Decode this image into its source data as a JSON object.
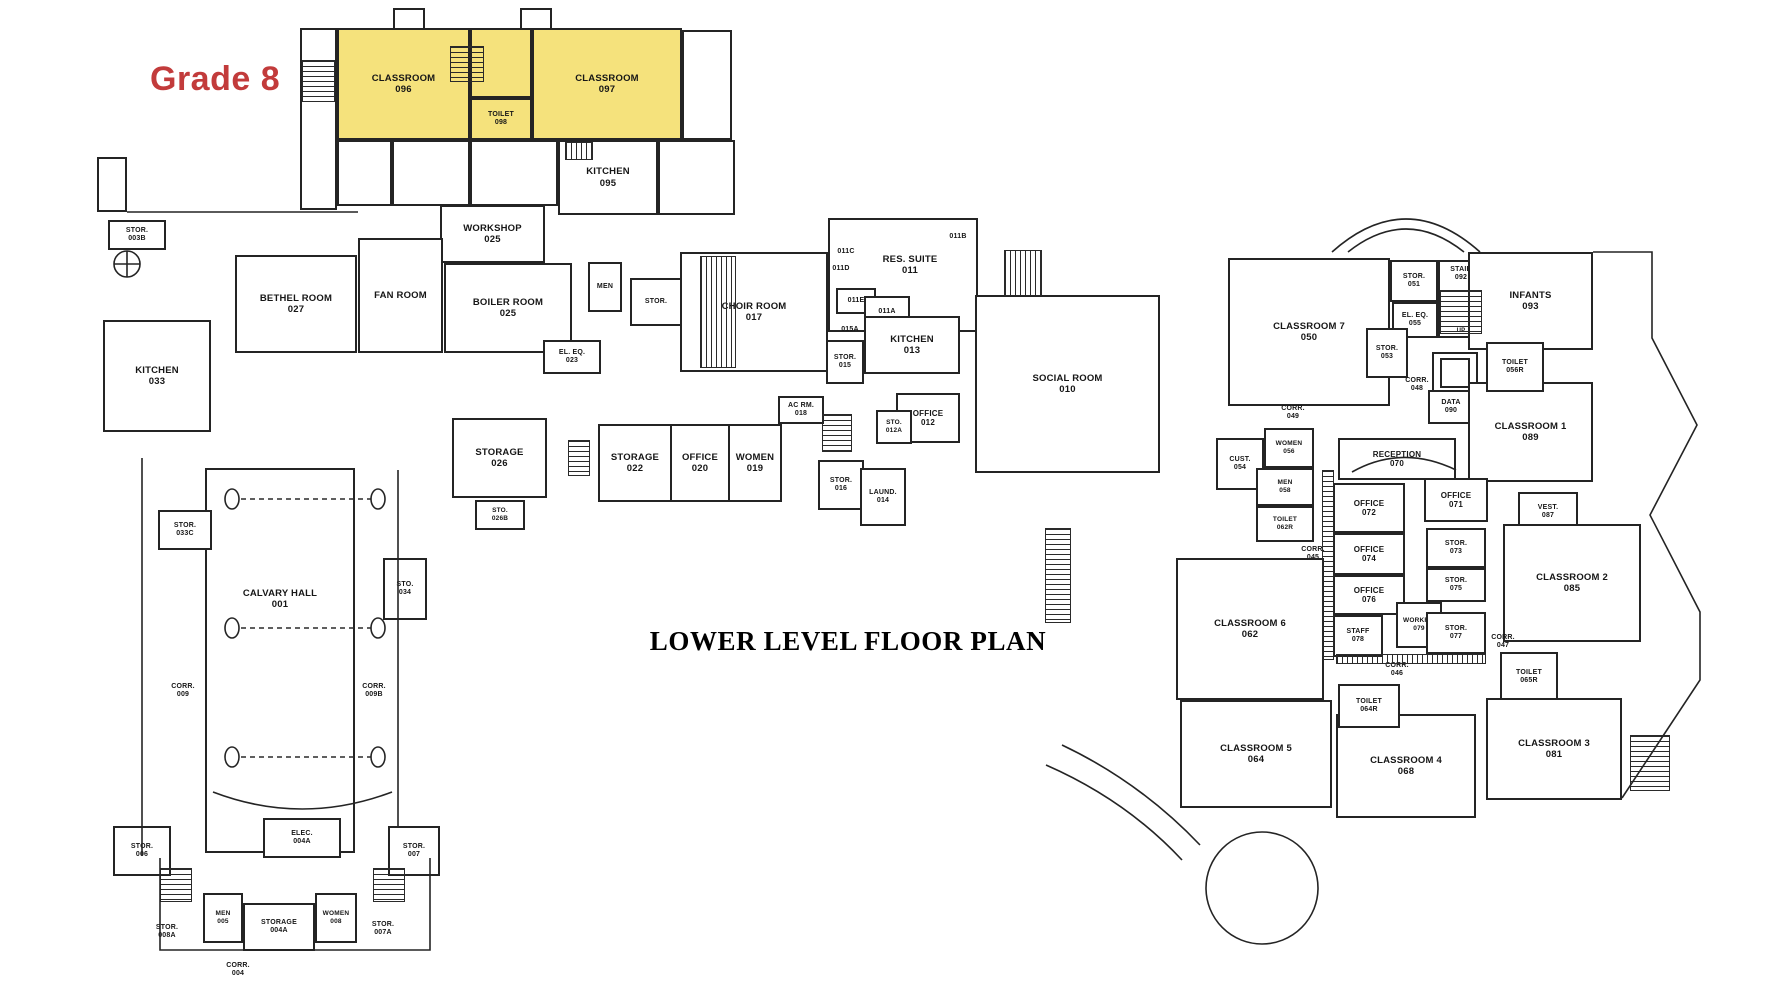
{
  "page": {
    "title": "LOWER LEVEL FLOOR PLAN",
    "annotation": "Grade 8"
  },
  "colors": {
    "highlight": "#F5E27C",
    "annotation": "#C23B3B",
    "wall": "#242424"
  },
  "rooms": [
    {
      "name": "CLASSROOM",
      "number": "096",
      "x": 337,
      "y": 28,
      "w": 133,
      "h": 112,
      "highlight": true
    },
    {
      "name": "",
      "number": "",
      "x": 470,
      "y": 28,
      "w": 62,
      "h": 70,
      "highlight": true
    },
    {
      "name": "TOILET",
      "number": "098",
      "x": 470,
      "y": 98,
      "w": 62,
      "h": 42,
      "highlight": true,
      "fs": 7
    },
    {
      "name": "CLASSROOM",
      "number": "097",
      "x": 532,
      "y": 28,
      "w": 150,
      "h": 112,
      "highlight": true
    },
    {
      "name": "KITCHEN",
      "number": "095",
      "x": 558,
      "y": 140,
      "w": 100,
      "h": 75
    },
    {
      "name": "WORKSHOP",
      "number": "025",
      "x": 440,
      "y": 205,
      "w": 105,
      "h": 58
    },
    {
      "name": "BETHEL ROOM",
      "number": "027",
      "x": 235,
      "y": 255,
      "w": 122,
      "h": 98
    },
    {
      "name": "FAN ROOM",
      "number": "",
      "x": 358,
      "y": 238,
      "w": 85,
      "h": 115
    },
    {
      "name": "BOILER ROOM",
      "number": "025",
      "x": 444,
      "y": 263,
      "w": 128,
      "h": 90
    },
    {
      "name": "MEN",
      "number": "",
      "x": 588,
      "y": 262,
      "w": 34,
      "h": 50,
      "fs": 7
    },
    {
      "name": "STOR.",
      "number": "",
      "x": 630,
      "y": 278,
      "w": 52,
      "h": 48,
      "fs": 7
    },
    {
      "name": "KITCHEN",
      "number": "033",
      "x": 103,
      "y": 320,
      "w": 108,
      "h": 112
    },
    {
      "name": "STOR.",
      "number": "003B",
      "x": 108,
      "y": 220,
      "w": 58,
      "h": 30,
      "fs": 7
    },
    {
      "name": "EL. EQ.",
      "number": "023",
      "x": 543,
      "y": 340,
      "w": 58,
      "h": 34,
      "fs": 7
    },
    {
      "name": "CHOIR ROOM",
      "number": "017",
      "x": 680,
      "y": 252,
      "w": 148,
      "h": 120
    },
    {
      "name": "",
      "number": "",
      "x": 828,
      "y": 218,
      "w": 150,
      "h": 114
    },
    {
      "name": "RES. SUITE",
      "number": "011",
      "x": 858,
      "y": 248,
      "w": 104,
      "h": 34,
      "nobox": true
    },
    {
      "name": "011C",
      "number": "",
      "x": 828,
      "y": 246,
      "w": 36,
      "h": 13,
      "nobox": true,
      "fs": 7
    },
    {
      "name": "011D",
      "number": "",
      "x": 823,
      "y": 263,
      "w": 36,
      "h": 13,
      "nobox": true,
      "fs": 7
    },
    {
      "name": "011B",
      "number": "",
      "x": 940,
      "y": 231,
      "w": 36,
      "h": 13,
      "nobox": true,
      "fs": 7
    },
    {
      "name": "011E",
      "number": "",
      "x": 836,
      "y": 288,
      "w": 40,
      "h": 26,
      "fs": 7
    },
    {
      "name": "011A",
      "number": "",
      "x": 864,
      "y": 296,
      "w": 46,
      "h": 32,
      "fs": 7
    },
    {
      "name": "KITCHEN",
      "number": "013",
      "x": 864,
      "y": 316,
      "w": 96,
      "h": 58
    },
    {
      "name": "015A",
      "number": "",
      "x": 832,
      "y": 324,
      "w": 36,
      "h": 13,
      "nobox": true,
      "fs": 7
    },
    {
      "name": "STOR.",
      "number": "015",
      "x": 826,
      "y": 340,
      "w": 38,
      "h": 44,
      "fs": 7
    },
    {
      "name": "SOCIAL ROOM",
      "number": "010",
      "x": 975,
      "y": 295,
      "w": 185,
      "h": 178
    },
    {
      "name": "OFFICE",
      "number": "012",
      "x": 896,
      "y": 393,
      "w": 64,
      "h": 50,
      "fs": 8
    },
    {
      "name": "STO.",
      "number": "012A",
      "x": 876,
      "y": 410,
      "w": 36,
      "h": 34,
      "fs": 6.5
    },
    {
      "name": "AC RM.",
      "number": "018",
      "x": 778,
      "y": 396,
      "w": 46,
      "h": 28,
      "fs": 7
    },
    {
      "name": "WOMEN",
      "number": "019",
      "x": 728,
      "y": 424,
      "w": 54,
      "h": 78
    },
    {
      "name": "OFFICE",
      "number": "020",
      "x": 670,
      "y": 424,
      "w": 60,
      "h": 78
    },
    {
      "name": "STORAGE",
      "number": "022",
      "x": 598,
      "y": 424,
      "w": 74,
      "h": 78
    },
    {
      "name": "STORAGE",
      "number": "026",
      "x": 452,
      "y": 418,
      "w": 95,
      "h": 80
    },
    {
      "name": "STO.",
      "number": "026B",
      "x": 475,
      "y": 500,
      "w": 50,
      "h": 30,
      "fs": 6.5
    },
    {
      "name": "STOR.",
      "number": "016",
      "x": 818,
      "y": 460,
      "w": 46,
      "h": 50,
      "fs": 7
    },
    {
      "name": "LAUND.",
      "number": "014",
      "x": 860,
      "y": 468,
      "w": 46,
      "h": 58,
      "fs": 7
    },
    {
      "name": "CALVARY HALL",
      "number": "001",
      "x": 205,
      "y": 468,
      "w": 150,
      "h": 385,
      "lt": 118
    },
    {
      "name": "STOR.",
      "number": "033C",
      "x": 158,
      "y": 510,
      "w": 54,
      "h": 40,
      "fs": 7
    },
    {
      "name": "STO.",
      "number": "034",
      "x": 383,
      "y": 558,
      "w": 44,
      "h": 62,
      "fs": 7
    },
    {
      "name": "CORR.",
      "number": "009",
      "x": 160,
      "y": 678,
      "w": 46,
      "h": 26,
      "nobox": true,
      "fs": 7
    },
    {
      "name": "CORR.",
      "number": "009B",
      "x": 350,
      "y": 678,
      "w": 48,
      "h": 26,
      "nobox": true,
      "fs": 7
    },
    {
      "name": "STOR.",
      "number": "006",
      "x": 113,
      "y": 826,
      "w": 58,
      "h": 50,
      "fs": 7
    },
    {
      "name": "ELEC.",
      "number": "004A",
      "x": 263,
      "y": 818,
      "w": 78,
      "h": 40,
      "fs": 7
    },
    {
      "name": "STOR.",
      "number": "007",
      "x": 388,
      "y": 826,
      "w": 52,
      "h": 50,
      "fs": 7
    },
    {
      "name": "STOR.",
      "number": "008A",
      "x": 142,
      "y": 918,
      "w": 50,
      "h": 28,
      "nobox": true,
      "fs": 7
    },
    {
      "name": "MEN",
      "number": "005",
      "x": 203,
      "y": 893,
      "w": 40,
      "h": 50,
      "fs": 6.5
    },
    {
      "name": "STORAGE",
      "number": "004A",
      "x": 243,
      "y": 903,
      "w": 72,
      "h": 48,
      "fs": 7
    },
    {
      "name": "WOMEN",
      "number": "008",
      "x": 315,
      "y": 893,
      "w": 42,
      "h": 50,
      "fs": 6.5
    },
    {
      "name": "STOR.",
      "number": "007A",
      "x": 358,
      "y": 915,
      "w": 50,
      "h": 28,
      "nobox": true,
      "fs": 7
    },
    {
      "name": "CORR.",
      "number": "004",
      "x": 215,
      "y": 956,
      "w": 46,
      "h": 28,
      "nobox": true,
      "fs": 7
    },
    {
      "name": "CLASSROOM 7",
      "number": "050",
      "x": 1228,
      "y": 258,
      "w": 162,
      "h": 148
    },
    {
      "name": "STOR.",
      "number": "051",
      "x": 1390,
      "y": 260,
      "w": 48,
      "h": 42,
      "fs": 7
    },
    {
      "name": "STAIR",
      "number": "092",
      "x": 1438,
      "y": 260,
      "w": 46,
      "h": 78,
      "fs": 7,
      "lt": 4
    },
    {
      "name": "UP",
      "number": "",
      "x": 1448,
      "y": 326,
      "w": 26,
      "h": 12,
      "nobox": true,
      "fs": 6
    },
    {
      "name": "EL. EQ.",
      "number": "055",
      "x": 1392,
      "y": 302,
      "w": 46,
      "h": 36,
      "fs": 7
    },
    {
      "name": "STOR.",
      "number": "053",
      "x": 1366,
      "y": 328,
      "w": 42,
      "h": 50,
      "fs": 7
    },
    {
      "name": "CORR.",
      "number": "048",
      "x": 1394,
      "y": 372,
      "w": 46,
      "h": 26,
      "nobox": true,
      "fs": 7
    },
    {
      "name": "DATA",
      "number": "090",
      "x": 1428,
      "y": 390,
      "w": 46,
      "h": 34,
      "fs": 7
    },
    {
      "name": "INFANTS",
      "number": "093",
      "x": 1468,
      "y": 252,
      "w": 125,
      "h": 98
    },
    {
      "name": "CLASSROOM 1",
      "number": "089",
      "x": 1468,
      "y": 382,
      "w": 125,
      "h": 100
    },
    {
      "name": "TOILET",
      "number": "056R",
      "x": 1486,
      "y": 342,
      "w": 58,
      "h": 50,
      "fs": 7
    },
    {
      "name": "CORR.",
      "number": "049",
      "x": 1270,
      "y": 400,
      "w": 46,
      "h": 26,
      "nobox": true,
      "fs": 7
    },
    {
      "name": "CUST.",
      "number": "054",
      "x": 1216,
      "y": 438,
      "w": 48,
      "h": 52,
      "fs": 7
    },
    {
      "name": "WOMEN",
      "number": "056",
      "x": 1264,
      "y": 428,
      "w": 50,
      "h": 40,
      "fs": 6.5
    },
    {
      "name": "MEN",
      "number": "058",
      "x": 1256,
      "y": 468,
      "w": 58,
      "h": 38,
      "fs": 6.5
    },
    {
      "name": "TOILET",
      "number": "062R",
      "x": 1256,
      "y": 506,
      "w": 58,
      "h": 36,
      "fs": 6.5
    },
    {
      "name": "RECEPTION",
      "number": "070",
      "x": 1338,
      "y": 438,
      "w": 118,
      "h": 42,
      "fs": 8
    },
    {
      "name": "OFFICE",
      "number": "072",
      "x": 1333,
      "y": 483,
      "w": 72,
      "h": 50,
      "fs": 8
    },
    {
      "name": "OFFICE",
      "number": "074",
      "x": 1333,
      "y": 533,
      "w": 72,
      "h": 42,
      "fs": 8
    },
    {
      "name": "OFFICE",
      "number": "076",
      "x": 1333,
      "y": 575,
      "w": 72,
      "h": 40,
      "fs": 8
    },
    {
      "name": "STAFF",
      "number": "078",
      "x": 1333,
      "y": 615,
      "w": 50,
      "h": 42,
      "fs": 7
    },
    {
      "name": "WORKRM",
      "number": "079",
      "x": 1396,
      "y": 602,
      "w": 46,
      "h": 46,
      "fs": 6.5
    },
    {
      "name": "OFFICE",
      "number": "071",
      "x": 1424,
      "y": 478,
      "w": 64,
      "h": 44,
      "fs": 8
    },
    {
      "name": "STOR.",
      "number": "073",
      "x": 1426,
      "y": 528,
      "w": 60,
      "h": 40,
      "fs": 7
    },
    {
      "name": "STOR.",
      "number": "075",
      "x": 1426,
      "y": 568,
      "w": 60,
      "h": 34,
      "fs": 7
    },
    {
      "name": "STOR.",
      "number": "077",
      "x": 1426,
      "y": 612,
      "w": 60,
      "h": 42,
      "fs": 7
    },
    {
      "name": "CORR.",
      "number": "045",
      "x": 1290,
      "y": 540,
      "w": 46,
      "h": 28,
      "nobox": true,
      "fs": 7
    },
    {
      "name": "CORR.",
      "number": "046",
      "x": 1374,
      "y": 656,
      "w": 46,
      "h": 28,
      "nobox": true,
      "fs": 7
    },
    {
      "name": "VEST.",
      "number": "087",
      "x": 1518,
      "y": 492,
      "w": 60,
      "h": 40,
      "fs": 7
    },
    {
      "name": "CLASSROOM 2",
      "number": "085",
      "x": 1503,
      "y": 524,
      "w": 138,
      "h": 118
    },
    {
      "name": "CORR.",
      "number": "047",
      "x": 1480,
      "y": 628,
      "w": 46,
      "h": 28,
      "nobox": true,
      "fs": 7
    },
    {
      "name": "TOILET",
      "number": "065R",
      "x": 1500,
      "y": 652,
      "w": 58,
      "h": 50,
      "fs": 7
    },
    {
      "name": "CLASSROOM 6",
      "number": "062",
      "x": 1176,
      "y": 558,
      "w": 148,
      "h": 142
    },
    {
      "name": "CLASSROOM 5",
      "number": "064",
      "x": 1180,
      "y": 700,
      "w": 152,
      "h": 108
    },
    {
      "name": "CLASSROOM 4",
      "number": "068",
      "x": 1336,
      "y": 714,
      "w": 140,
      "h": 104
    },
    {
      "name": "TOILET",
      "number": "064R",
      "x": 1338,
      "y": 684,
      "w": 62,
      "h": 44,
      "fs": 7
    },
    {
      "name": "CLASSROOM 3",
      "number": "081",
      "x": 1486,
      "y": 698,
      "w": 136,
      "h": 102
    }
  ]
}
